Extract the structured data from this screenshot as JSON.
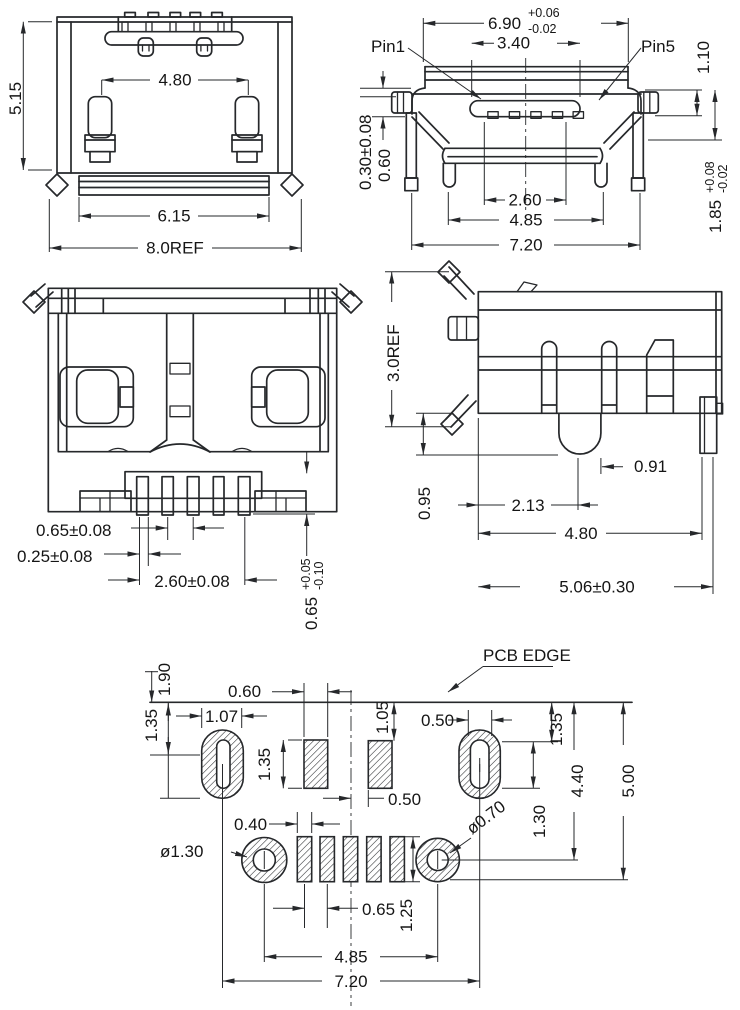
{
  "views": {
    "rear": {
      "dims": {
        "height": "5.15",
        "latch_span": "4.80",
        "base_width": "6.15",
        "overall_width": "8.0REF"
      }
    },
    "front": {
      "labels": {
        "pin1": "Pin1",
        "pin5": "Pin5"
      },
      "dims": {
        "shell_width": "6.90",
        "shell_width_tol_upper": "+0.06",
        "shell_width_tol_lower": "-0.02",
        "tongue_width": "3.40",
        "top_clearance": "1.10",
        "standoff": "0.30±0.08",
        "foot_height": "0.60",
        "contact_span": "2.60",
        "leg_span": "4.85",
        "overall_width": "7.20",
        "mating_height": "1.85",
        "mating_height_tol_upper": "+0.08",
        "mating_height_tol_lower": "-0.02"
      }
    },
    "bottom": {
      "dims": {
        "pin_width": "0.65±0.08",
        "pin_offset": "0.25±0.08",
        "pin_row_span": "2.60±0.08",
        "tail_length": "0.65",
        "tail_tol_upper": "+0.05",
        "tail_tol_lower": "-0.10"
      }
    },
    "side": {
      "dims": {
        "height": "3.0REF",
        "lug_depth": "0.95",
        "lug_center": "2.13",
        "leg_span": "4.80",
        "overall_depth": "5.06±0.30",
        "lug_width": "0.91"
      }
    },
    "pcb": {
      "labels": {
        "edge": "PCB EDGE"
      },
      "dims": {
        "edge_overhang": "1.90",
        "slot_center_offset": "1.35",
        "slot_width": "1.07",
        "pad_width": "0.60",
        "pad_height": "1.35",
        "pad_top_offset": "1.05",
        "slot_hole_width": "0.50",
        "pad_right_offset": "0.50",
        "right_slot_offset": "1.35",
        "slot_hole_height": "1.30",
        "hole_row_offset": "4.40",
        "board_depth": "5.00",
        "small_hole_dia": "ø0.70",
        "large_hole_dia": "ø1.30",
        "pin_pad_width": "0.40",
        "pin_pad_pitch": "0.65",
        "pin_pad_height": "1.25",
        "hole_span": "4.85",
        "slot_span": "7.20"
      }
    }
  },
  "colors": {
    "line": "#26282b",
    "background": "#ffffff"
  }
}
